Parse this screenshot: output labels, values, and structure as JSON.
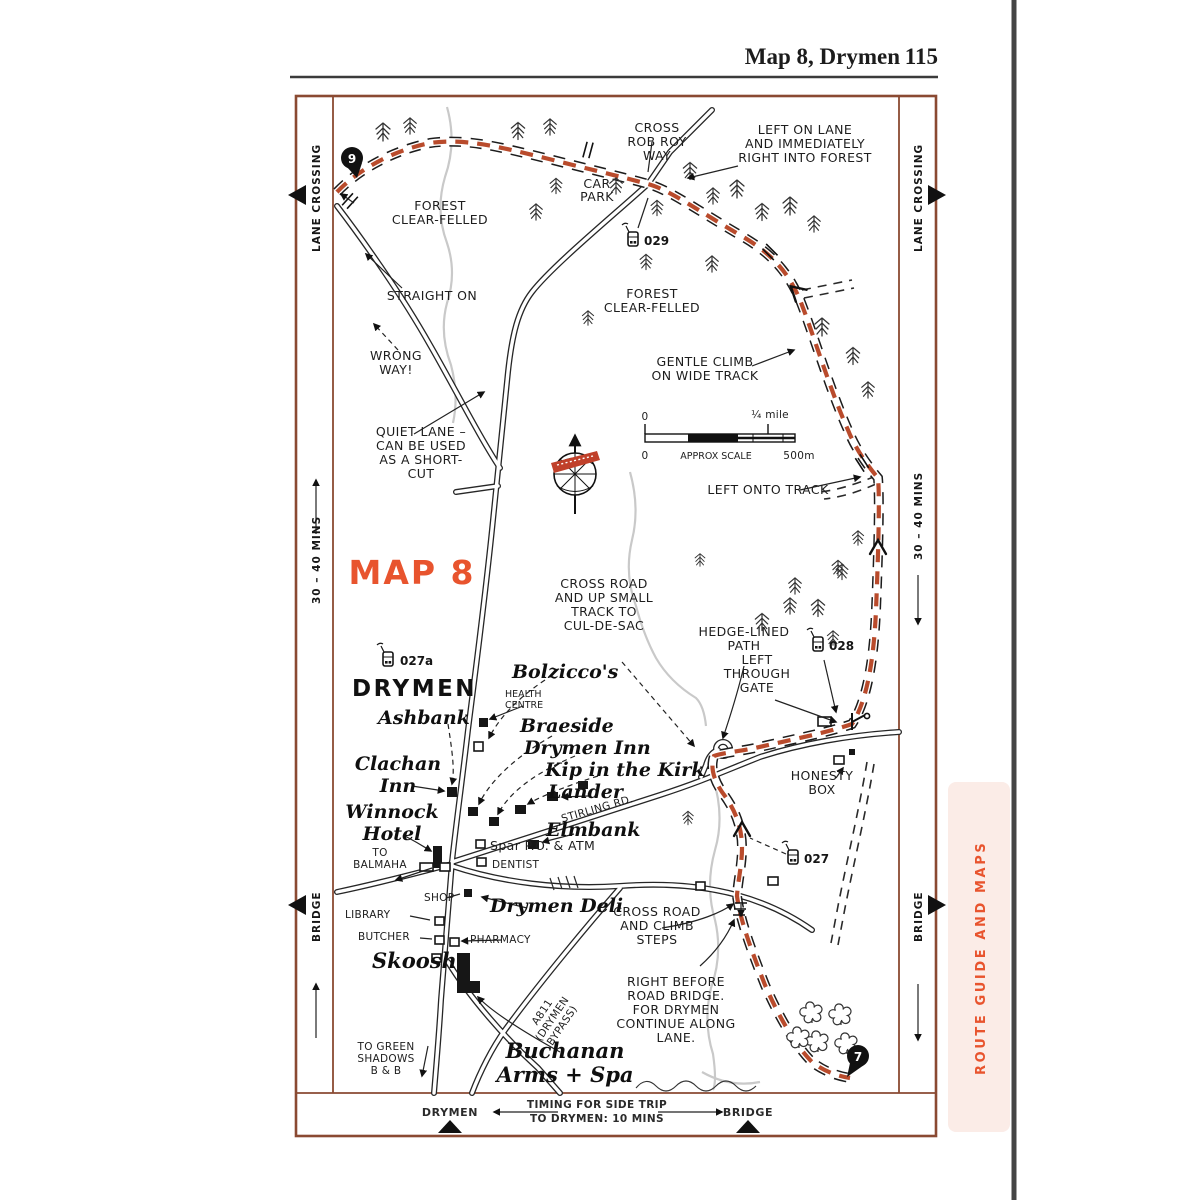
{
  "header": {
    "title": "Map 8, Drymen",
    "page_number": "115"
  },
  "sidebar": {
    "label": "ROUTE GUIDE AND MAPS"
  },
  "map": {
    "title": "MAP 8",
    "colors": {
      "accent": "#e8542e",
      "route": "#b94b2c",
      "frame": "#8a4a32",
      "sidebar_bg": "#fbece7"
    },
    "margins": {
      "lane_crossing": "LANE CROSSING",
      "mins_30_40": "30 – 40 MINS",
      "bridge": "BRIDGE"
    },
    "bottom_band": {
      "drymen": "DRYMEN",
      "timing": "TIMING FOR SIDE TRIP|TO DRYMEN: 10 MINS",
      "bridge": "BRIDGE"
    },
    "scale_bar": {
      "zero_top": "0",
      "quarter_mile": "¼ mile",
      "zero_bottom": "0",
      "approx": "APPROX SCALE",
      "m_500": "500m"
    },
    "pins": {
      "pin_9": "9",
      "pin_7": "7"
    },
    "waypoints": {
      "w029": "029",
      "w027a": "027a",
      "w028": "028",
      "w027": "027"
    },
    "annotations": {
      "cross_rob_roy_way": "CROSS|ROB ROY|WAY",
      "left_on_lane": "LEFT ON LANE|AND IMMEDIATELY|RIGHT INTO FOREST",
      "car_park": "CAR|PARK",
      "forest_clear_felled_nw": "FOREST|CLEAR-FELLED",
      "straight_on": "STRAIGHT ON",
      "wrong_way": "WRONG|WAY!",
      "forest_clear_felled_mid": "FOREST|CLEAR-FELLED",
      "gentle_climb": "GENTLE CLIMB|ON WIDE TRACK",
      "quiet_lane": "QUIET LANE –|CAN BE USED|AS A SHORT-|CUT",
      "left_onto_track": "LEFT ONTO TRACK",
      "cross_road_cul_de_sac": "CROSS ROAD|AND UP SMALL|TRACK TO|CUL-DE-SAC",
      "hedge_lined_path": "HEDGE-LINED|PATH",
      "left_through_gate": "LEFT|THROUGH|GATE",
      "honesty_box": "HONESTY|BOX",
      "cross_road_climb_steps": "CROSS ROAD|AND CLIMB|STEPS",
      "right_before_road_bridge": "RIGHT BEFORE|ROAD BRIDGE.|FOR DRYMEN|CONTINUE ALONG|LANE.",
      "to_balmaha": "TO|BALMAHA",
      "to_green_shadows": "TO GREEN|SHADOWS|B & B",
      "stirling_rd": "STIRLING RD.",
      "a811_bypass": "A811|(DRYMEN|BYPASS)"
    },
    "places": {
      "drymen_town": "DRYMEN",
      "bolziccos": "Bolzicco's",
      "health_centre": "HEALTH|CENTRE",
      "ashbank": "Ashbank",
      "braeside": "Braeside",
      "drymen_inn": "Drymen Inn",
      "kip_in_the_kirk": "Kip in the Kirk",
      "lander": "Lander",
      "clachan_inn": "Clachan|Inn",
      "winnock_hotel": "Winnock|Hotel",
      "elmbank": "Elmbank",
      "spar": "Spar P.O. & ATM",
      "dentist": "DENTIST",
      "shop": "SHOP",
      "library": "LIBRARY",
      "butcher": "BUTCHER",
      "drymen_deli": "Drymen Deli",
      "pharmacy": "PHARMACY",
      "skoosh": "Skoosh",
      "buchanan_arms": "Buchanan|Arms + Spa"
    }
  }
}
